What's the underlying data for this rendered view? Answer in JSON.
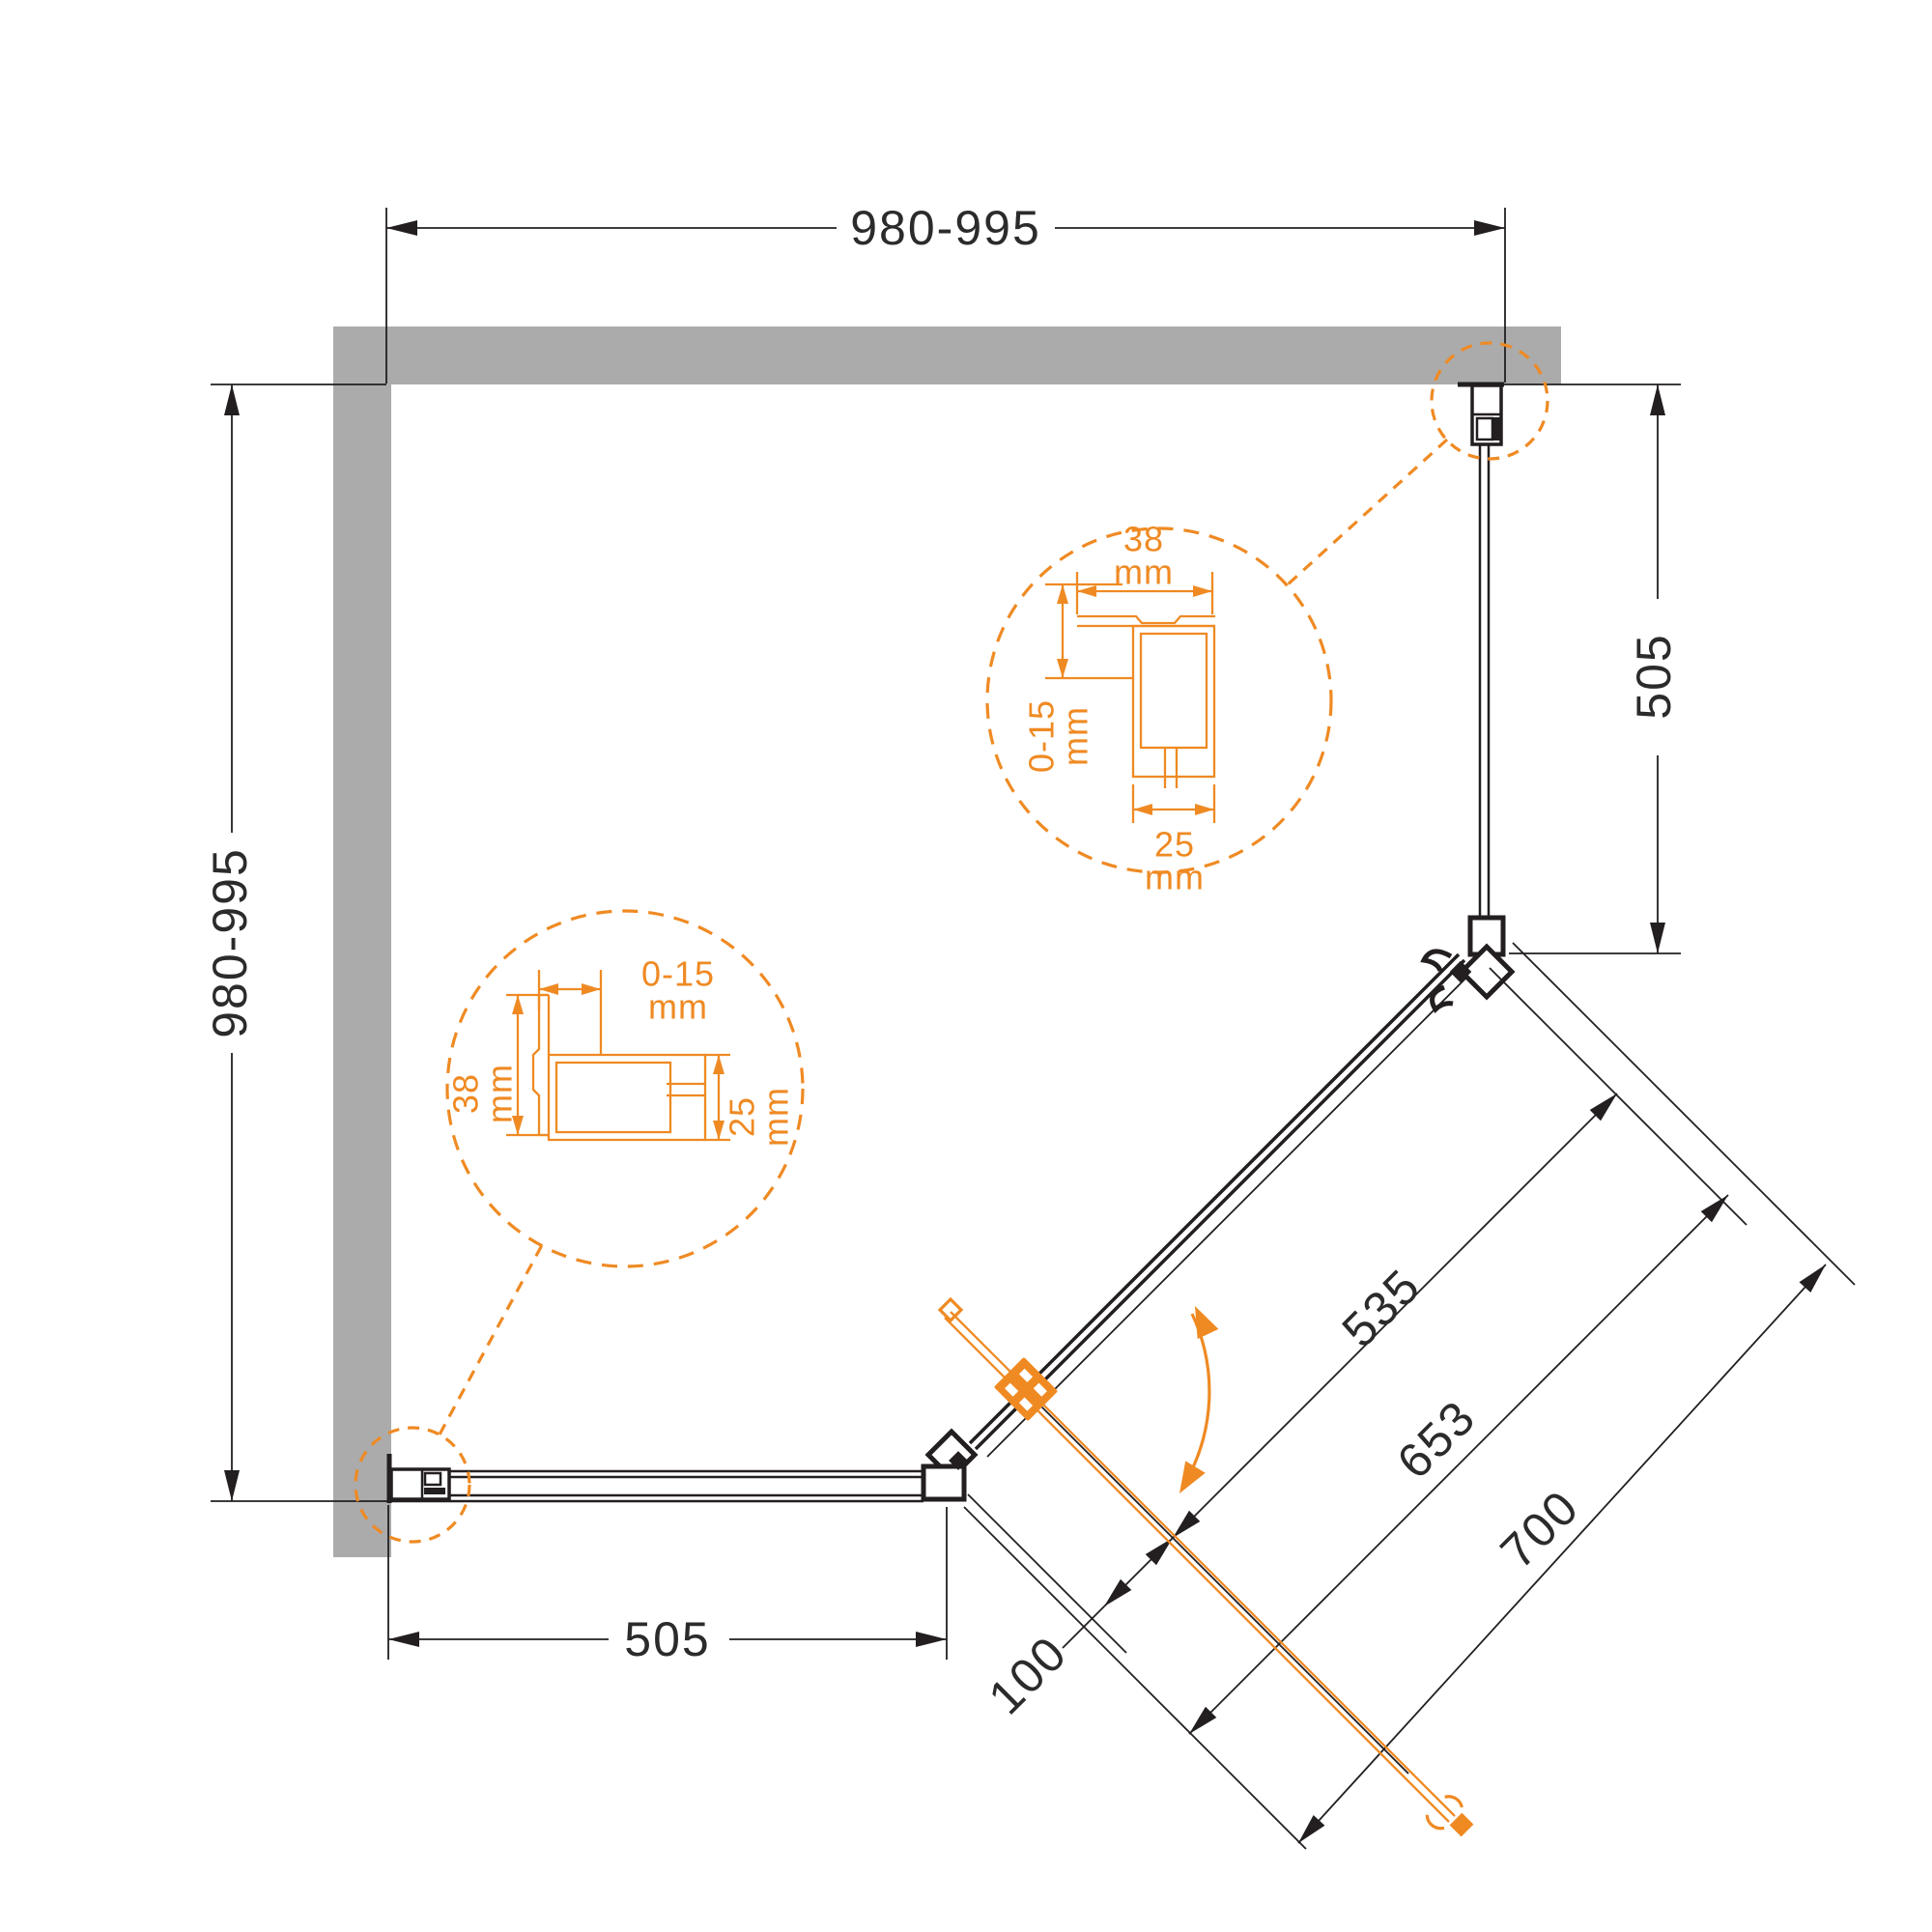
{
  "diagram": {
    "title": "corner-shower-enclosure-plan",
    "dims": {
      "top": "980-995",
      "left": "980-995",
      "right": "505",
      "bottom": "505",
      "door_glass": "535",
      "door_opening": "653",
      "door_total": "700",
      "pivot_offset": "100"
    },
    "detail_right": {
      "width": "38",
      "width_unit": "mm",
      "adjust": "0-15",
      "adjust_unit": "mm",
      "depth": "25",
      "depth_unit": "mm"
    },
    "detail_left": {
      "adjust": "0-15",
      "adjust_unit": "mm",
      "width": "38",
      "width_unit": "mm",
      "depth": "25",
      "depth_unit": "mm"
    },
    "colors": {
      "accent": "#EF8A23",
      "wall": "#ABABAB",
      "line": "#231F20",
      "text": "#2B2B2B"
    }
  }
}
